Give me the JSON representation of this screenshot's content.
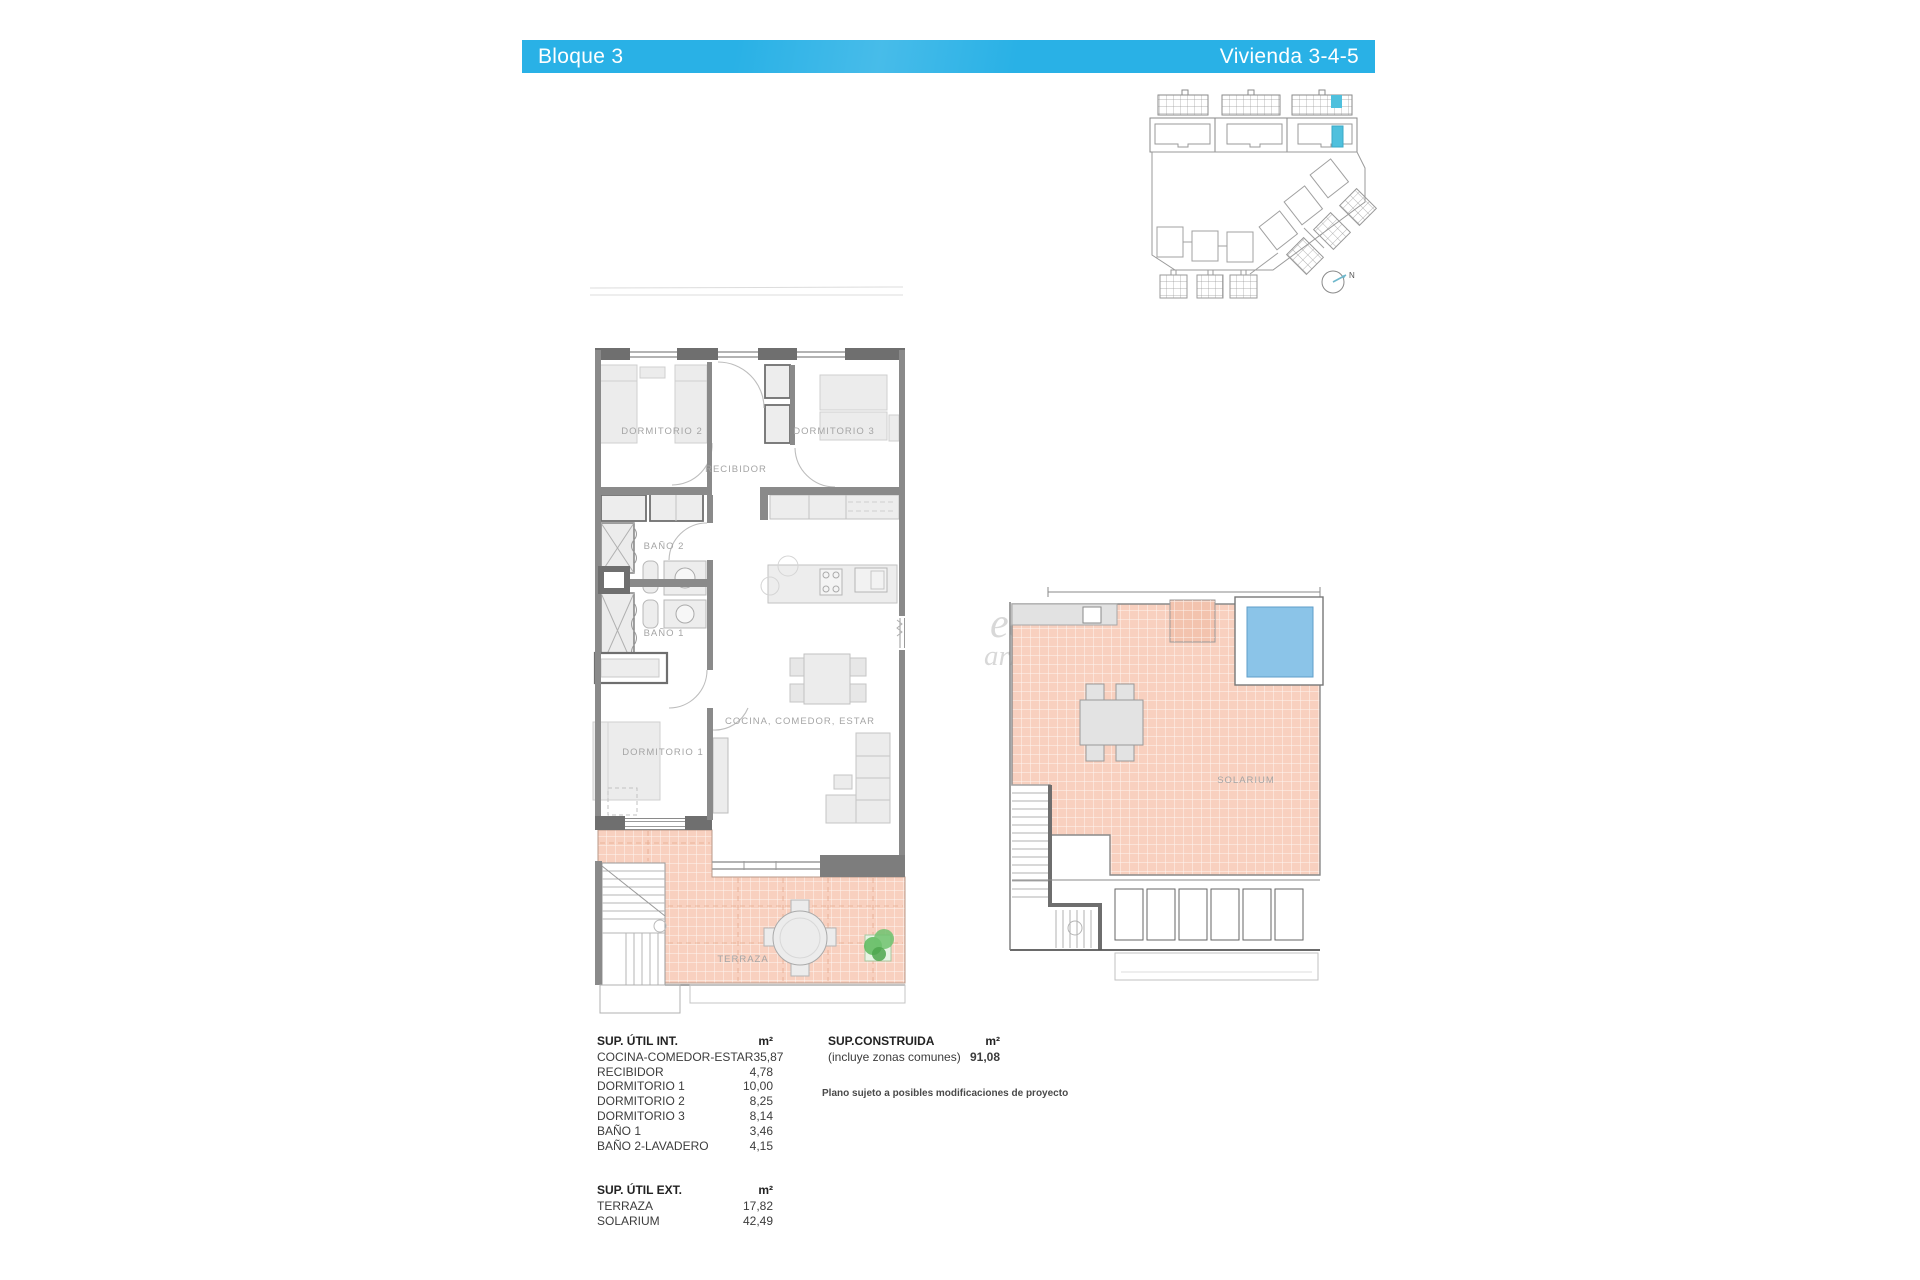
{
  "header": {
    "left_label": "Bloque 3",
    "right_label": "Vivienda 3-4-5",
    "bar_color": "#29b1e6"
  },
  "site_plan": {
    "north_label": "N",
    "highlight_color": "#4fc0dd"
  },
  "floor_plan": {
    "labels": {
      "dormitorio2": "DORMITORIO 2",
      "recibidor": "RECIBIDOR",
      "dormitorio3": "DORMITORIO 3",
      "bano2": "BAÑO 2",
      "bano1": "BAÑO 1",
      "dormitorio1": "DORMITORIO 1",
      "cocina": "COCINA, COMEDOR, ESTAR",
      "terraza": "TERRAZA"
    },
    "terrace_color": "#f8d0bf"
  },
  "solarium_plan": {
    "label": "SOLARIUM",
    "pool_color": "#8bc4e8"
  },
  "watermark": {
    "line1": "eas",
    "line2": "arket"
  },
  "tables": {
    "util_int": {
      "title": "SUP. ÚTIL INT.",
      "unit": "m²",
      "rows": [
        {
          "label": "COCINA-COMEDOR-ESTAR",
          "value": "35,87"
        },
        {
          "label": "RECIBIDOR",
          "value": "4,78"
        },
        {
          "label": "DORMITORIO 1",
          "value": "10,00"
        },
        {
          "label": "DORMITORIO 2",
          "value": "8,25"
        },
        {
          "label": "DORMITORIO 3",
          "value": "8,14"
        },
        {
          "label": "BAÑO 1",
          "value": "3,46"
        },
        {
          "label": "BAÑO 2-LAVADERO",
          "value": "4,15"
        }
      ]
    },
    "util_ext": {
      "title": "SUP. ÚTIL EXT.",
      "unit": "m²",
      "rows": [
        {
          "label": "TERRAZA",
          "value": "17,82"
        },
        {
          "label": "SOLARIUM",
          "value": "42,49"
        }
      ]
    },
    "construida": {
      "title": "SUP.CONSTRUIDA",
      "unit": "m²",
      "subtitle": "(incluye zonas comunes)",
      "value": "91,08"
    },
    "note": "Plano sujeto a posibles modificaciones de proyecto"
  }
}
